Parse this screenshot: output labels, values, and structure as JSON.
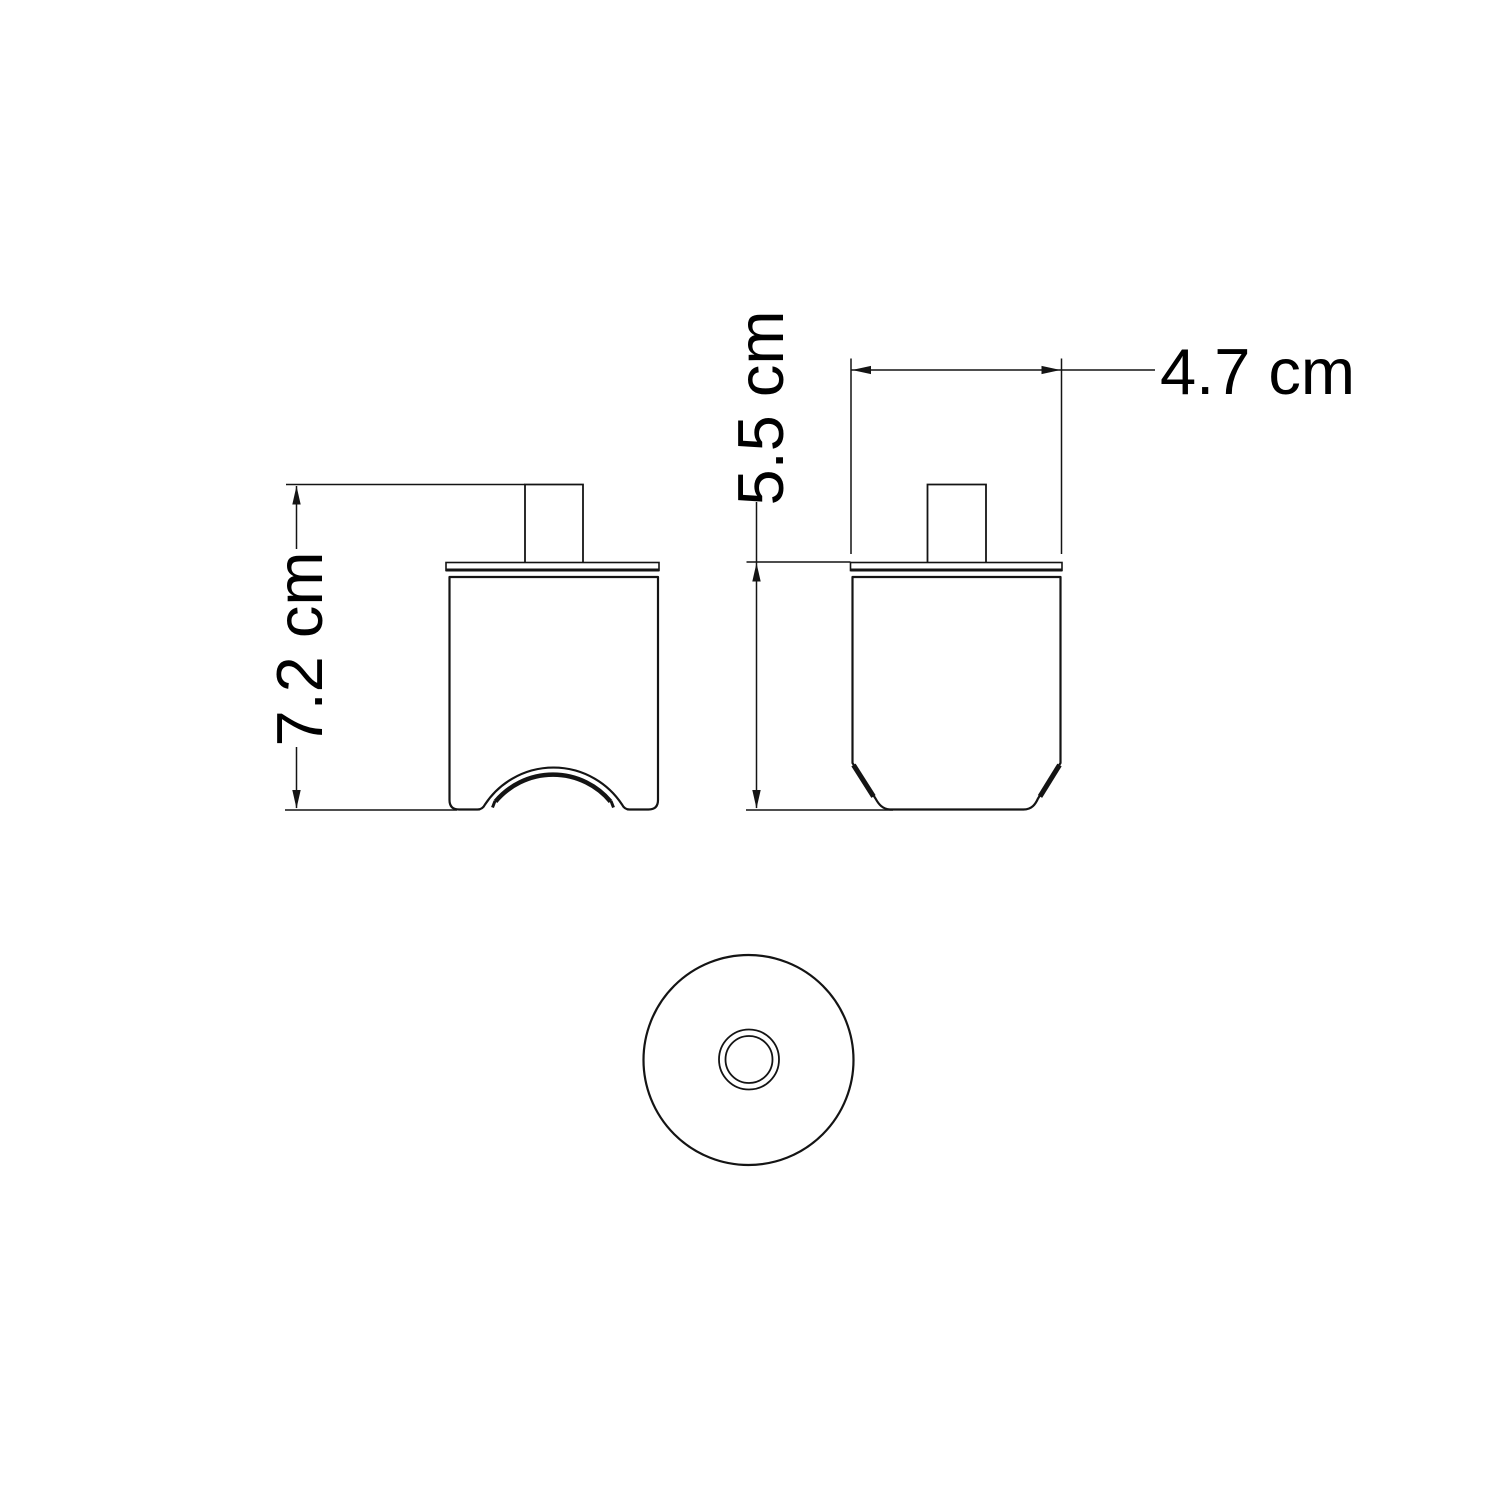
{
  "drawing": {
    "background_color": "#ffffff",
    "line_color": "#141414",
    "text_color": "#000000",
    "views": {
      "front_view": "front elevation with arched cable cutout",
      "side_view": "side elevation with chamfered base",
      "bottom_view": "bottom view with concentric cable hole"
    },
    "dimensions": {
      "front_height": {
        "label": "7.2 cm",
        "orientation": "vertical"
      },
      "side_height": {
        "label": "5.5 cm",
        "orientation": "vertical"
      },
      "side_width": {
        "label": "4.7 cm",
        "orientation": "horizontal"
      }
    }
  }
}
